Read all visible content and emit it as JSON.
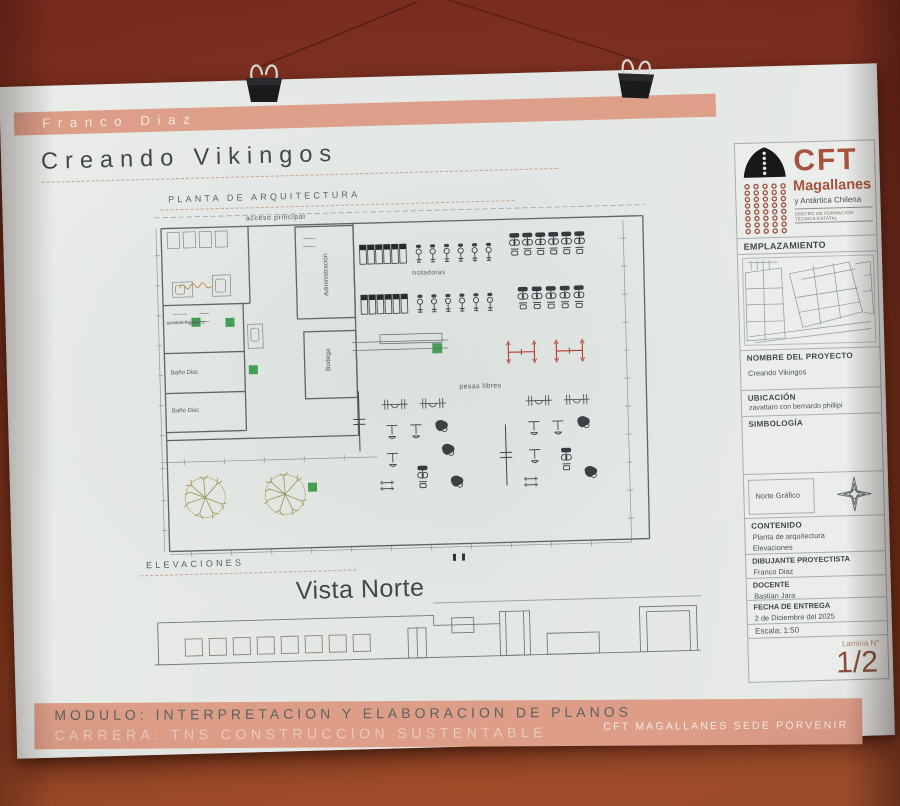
{
  "colors": {
    "wall": "#86341f",
    "paper": "#e6e9e7",
    "salmon_band": "#dd9d87",
    "brand_rust": "#a5503c",
    "plan_line": "#5b6368",
    "accent_green": "#3d9b4d",
    "accent_red": "#b03526"
  },
  "header": {
    "author": "Franco Diaz",
    "title": "Creando Vikingos"
  },
  "plan": {
    "section_label": "PLANTA DE ARQUITECTURA",
    "labels": {
      "acceso": "acceso principal",
      "administracion": "Administración",
      "bodega": "Bodega",
      "servicio": "servicio higienico",
      "bano_disc_1": "Baño Disc",
      "bano_disc_2": "Baño Disc",
      "trotadoras": "trotadoras",
      "pesas_libres": "pesas libres"
    }
  },
  "elevations": {
    "section_label": "ELEVACIONES",
    "view_title": "Vista Norte"
  },
  "titleblock": {
    "logo": {
      "acronym": "CFT",
      "name": "Magallanes",
      "subtitle": "y Antártica Chilena",
      "tagline": "CENTRO DE FORMACIÓN TÉCNICA ESTATAL"
    },
    "emplazamiento_label": "EMPLAZAMIENTO",
    "nombre_proyecto_label": "NOMBRE DEL PROYECTO",
    "nombre_proyecto_value": "Creando Vikingos",
    "ubicacion_label": "UBICACIÓN",
    "ubicacion_value": "zavattaro con bernardo phillipi",
    "simbologia_label": "SIMBOLOGÍA",
    "norte_grafico_label": "Norte Gráfico",
    "contenido_label": "CONTENIDO",
    "contenido_items": [
      "Planta de arquitectura",
      "Elevaciones"
    ],
    "dibujante_label": "DIBUJANTE PROYECTISTA",
    "dibujante_value": "Franco Diaz",
    "docente_label": "DOCENTE",
    "docente_value": "Bastian Jara",
    "fecha_label": "FECHA DE ENTREGA",
    "fecha_value": "2 de Diciembre del 2025",
    "escala": "Escala: 1:50",
    "lamina_label": "Lamina N°",
    "lamina_value": "1/2"
  },
  "footer": {
    "modulo": "MODULO: INTERPRETACION Y ELABORACION DE PLANOS",
    "carrera": "CARRERA: TNS CONSTRUCCION SUSTENTABLE",
    "sede": "CFT MAGALLANES SEDE PORVENIR"
  }
}
